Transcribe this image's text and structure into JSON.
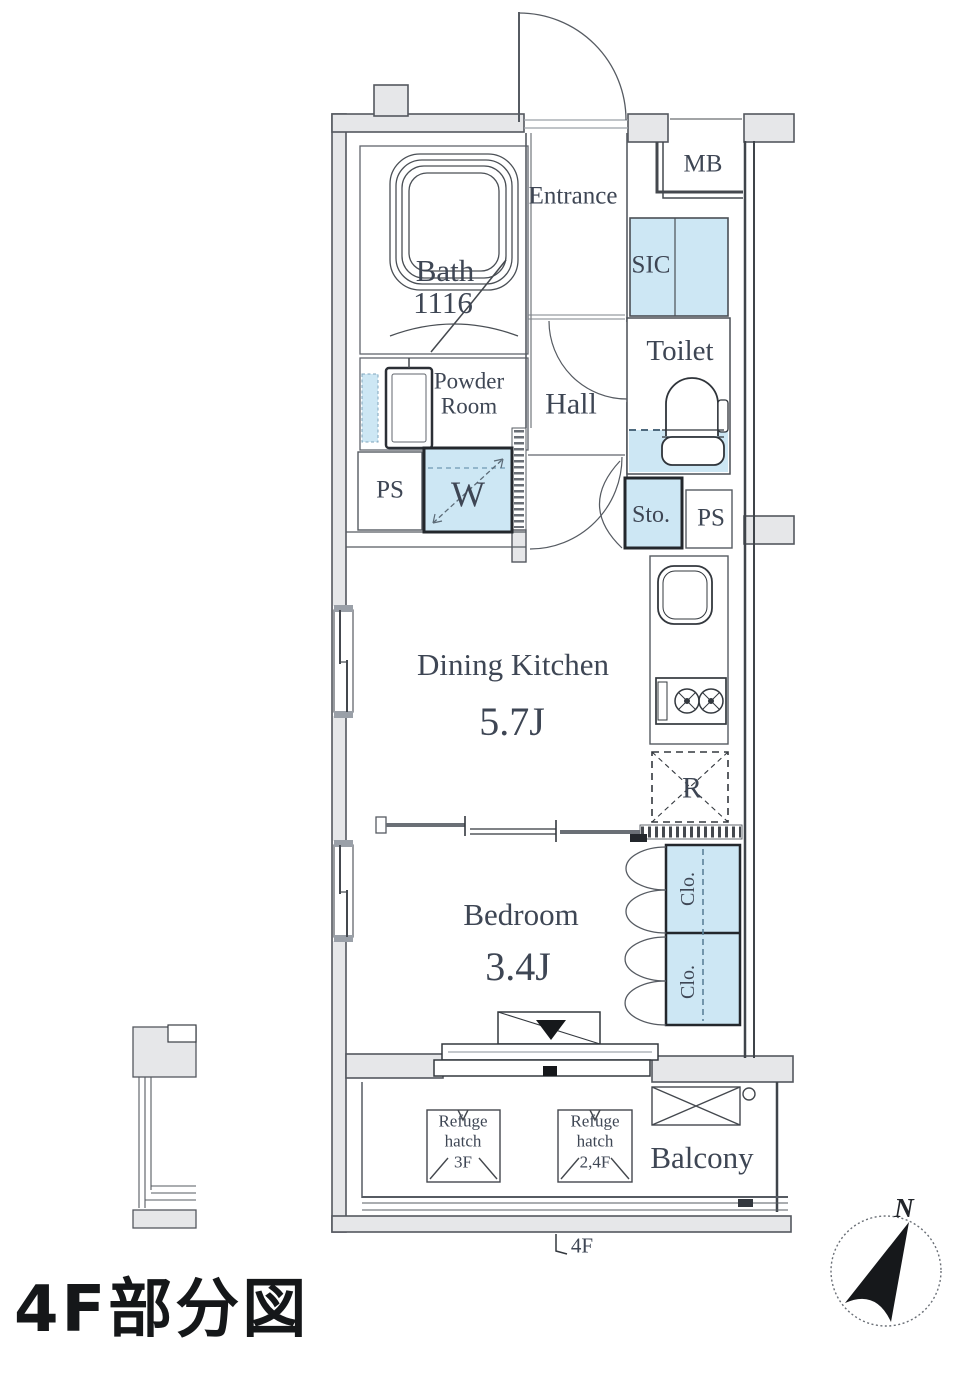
{
  "floor_plan": {
    "caption": "4F部分図",
    "floor_marker": "4F",
    "compass": {
      "north": "N"
    },
    "rooms": {
      "entrance": "Entrance",
      "meter_box": "MB",
      "bath_name": "Bath",
      "bath_size": "1116",
      "shoe_closet": "SIC",
      "toilet": "Toilet",
      "powder_line1": "Powder",
      "powder_line2": "Room",
      "hall": "Hall",
      "pipe_space_left": "PS",
      "pipe_space_right": "PS",
      "washer": "W",
      "storage": "Sto.",
      "dining_kitchen_name": "Dining Kitchen",
      "dining_kitchen_size": "5.7J",
      "refrigerator": "R",
      "bedroom_name": "Bedroom",
      "bedroom_size": "3.4J",
      "closet_upper": "Clo.",
      "closet_lower": "Clo.",
      "balcony": "Balcony"
    },
    "balcony_features": {
      "refuge_hatch_1": {
        "line1": "Refuge",
        "line2": "hatch",
        "line3": "3F"
      },
      "refuge_hatch_2": {
        "line1": "Refuge",
        "line2": "hatch",
        "line3": "2,4F"
      }
    },
    "colors": {
      "highlight_fill": "#cde7f4",
      "wall_fill": "#e6e7e9",
      "label_color": "#3e4654"
    }
  }
}
